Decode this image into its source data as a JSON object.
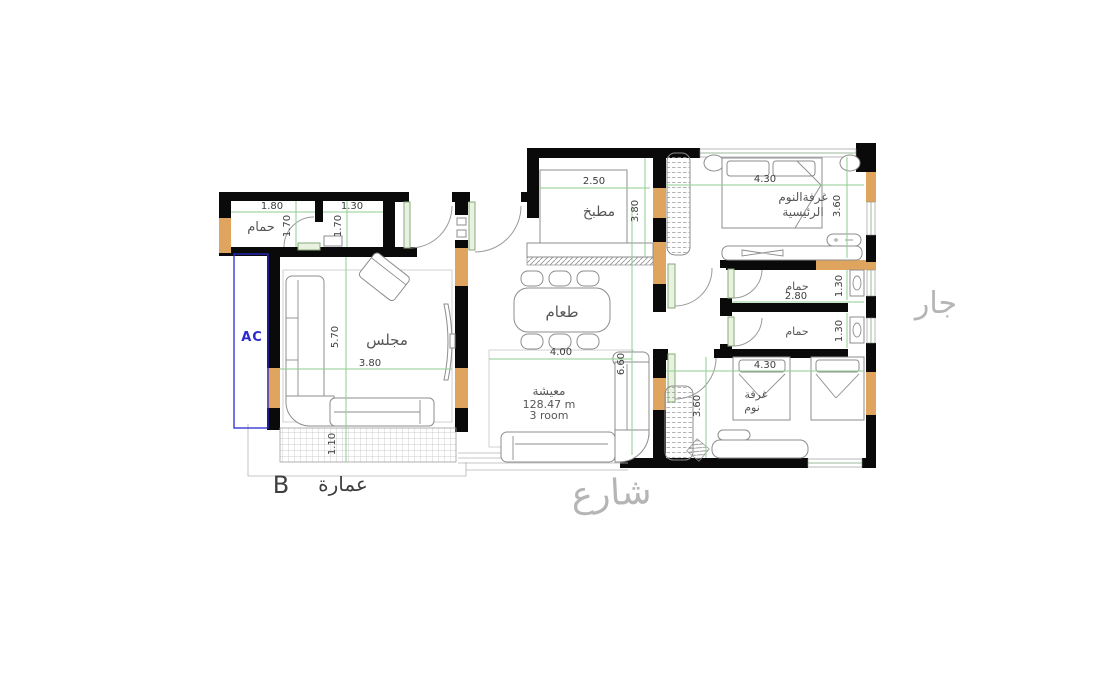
{
  "plan": {
    "rooms": {
      "bath_main": {
        "label": "حمام"
      },
      "majlis": {
        "label": "مجلس"
      },
      "kitchen": {
        "label": "مطبخ"
      },
      "dining": {
        "label": "طعام"
      },
      "living": {
        "label": "معيشة",
        "area": "128.47 m",
        "rooms_note": "3 room"
      },
      "master_bedroom": {
        "label_line1": "غرفةالنوم",
        "label_line2": "الرئيسية"
      },
      "bath_1": {
        "label": "حمام"
      },
      "bath_2": {
        "label": "حمام"
      },
      "bedroom": {
        "label_line1": "غرفة",
        "label_line2": "نوم"
      }
    },
    "dims": {
      "bath_w": "1.80",
      "wc_w": "1.30",
      "bath_d1": "1.70",
      "bath_d2": "1.70",
      "majlis_h": "5.70",
      "majlis_w": "3.80",
      "balcony_d": "1.10",
      "kitchen_w": "2.50",
      "kitchen_h": "3.80",
      "living_w": "4.00",
      "living_h": "6.60",
      "master_w": "4.30",
      "master_h": "3.60",
      "bath1_w": "2.80",
      "bath1_h": "1.30",
      "bath2_h": "1.30",
      "bedroom_w": "4.30",
      "bedroom_h": "3.60"
    },
    "annotations": {
      "ac": "AC",
      "building_letter": "B",
      "building_name": "عمارة",
      "street": "شارع",
      "neighbor": "جار"
    }
  },
  "colors": {
    "wall": "#0a0a0a",
    "column": "#dfa55e",
    "window_green": "#9bb89b",
    "door_fill": "#e9f2e1",
    "door_stroke": "#86a977",
    "dim_green": "#8fce8f",
    "furniture": "#8c8c8c",
    "label": "#565656",
    "faded": "#b5b5b5",
    "ac_blue": "#2a2ad0"
  }
}
